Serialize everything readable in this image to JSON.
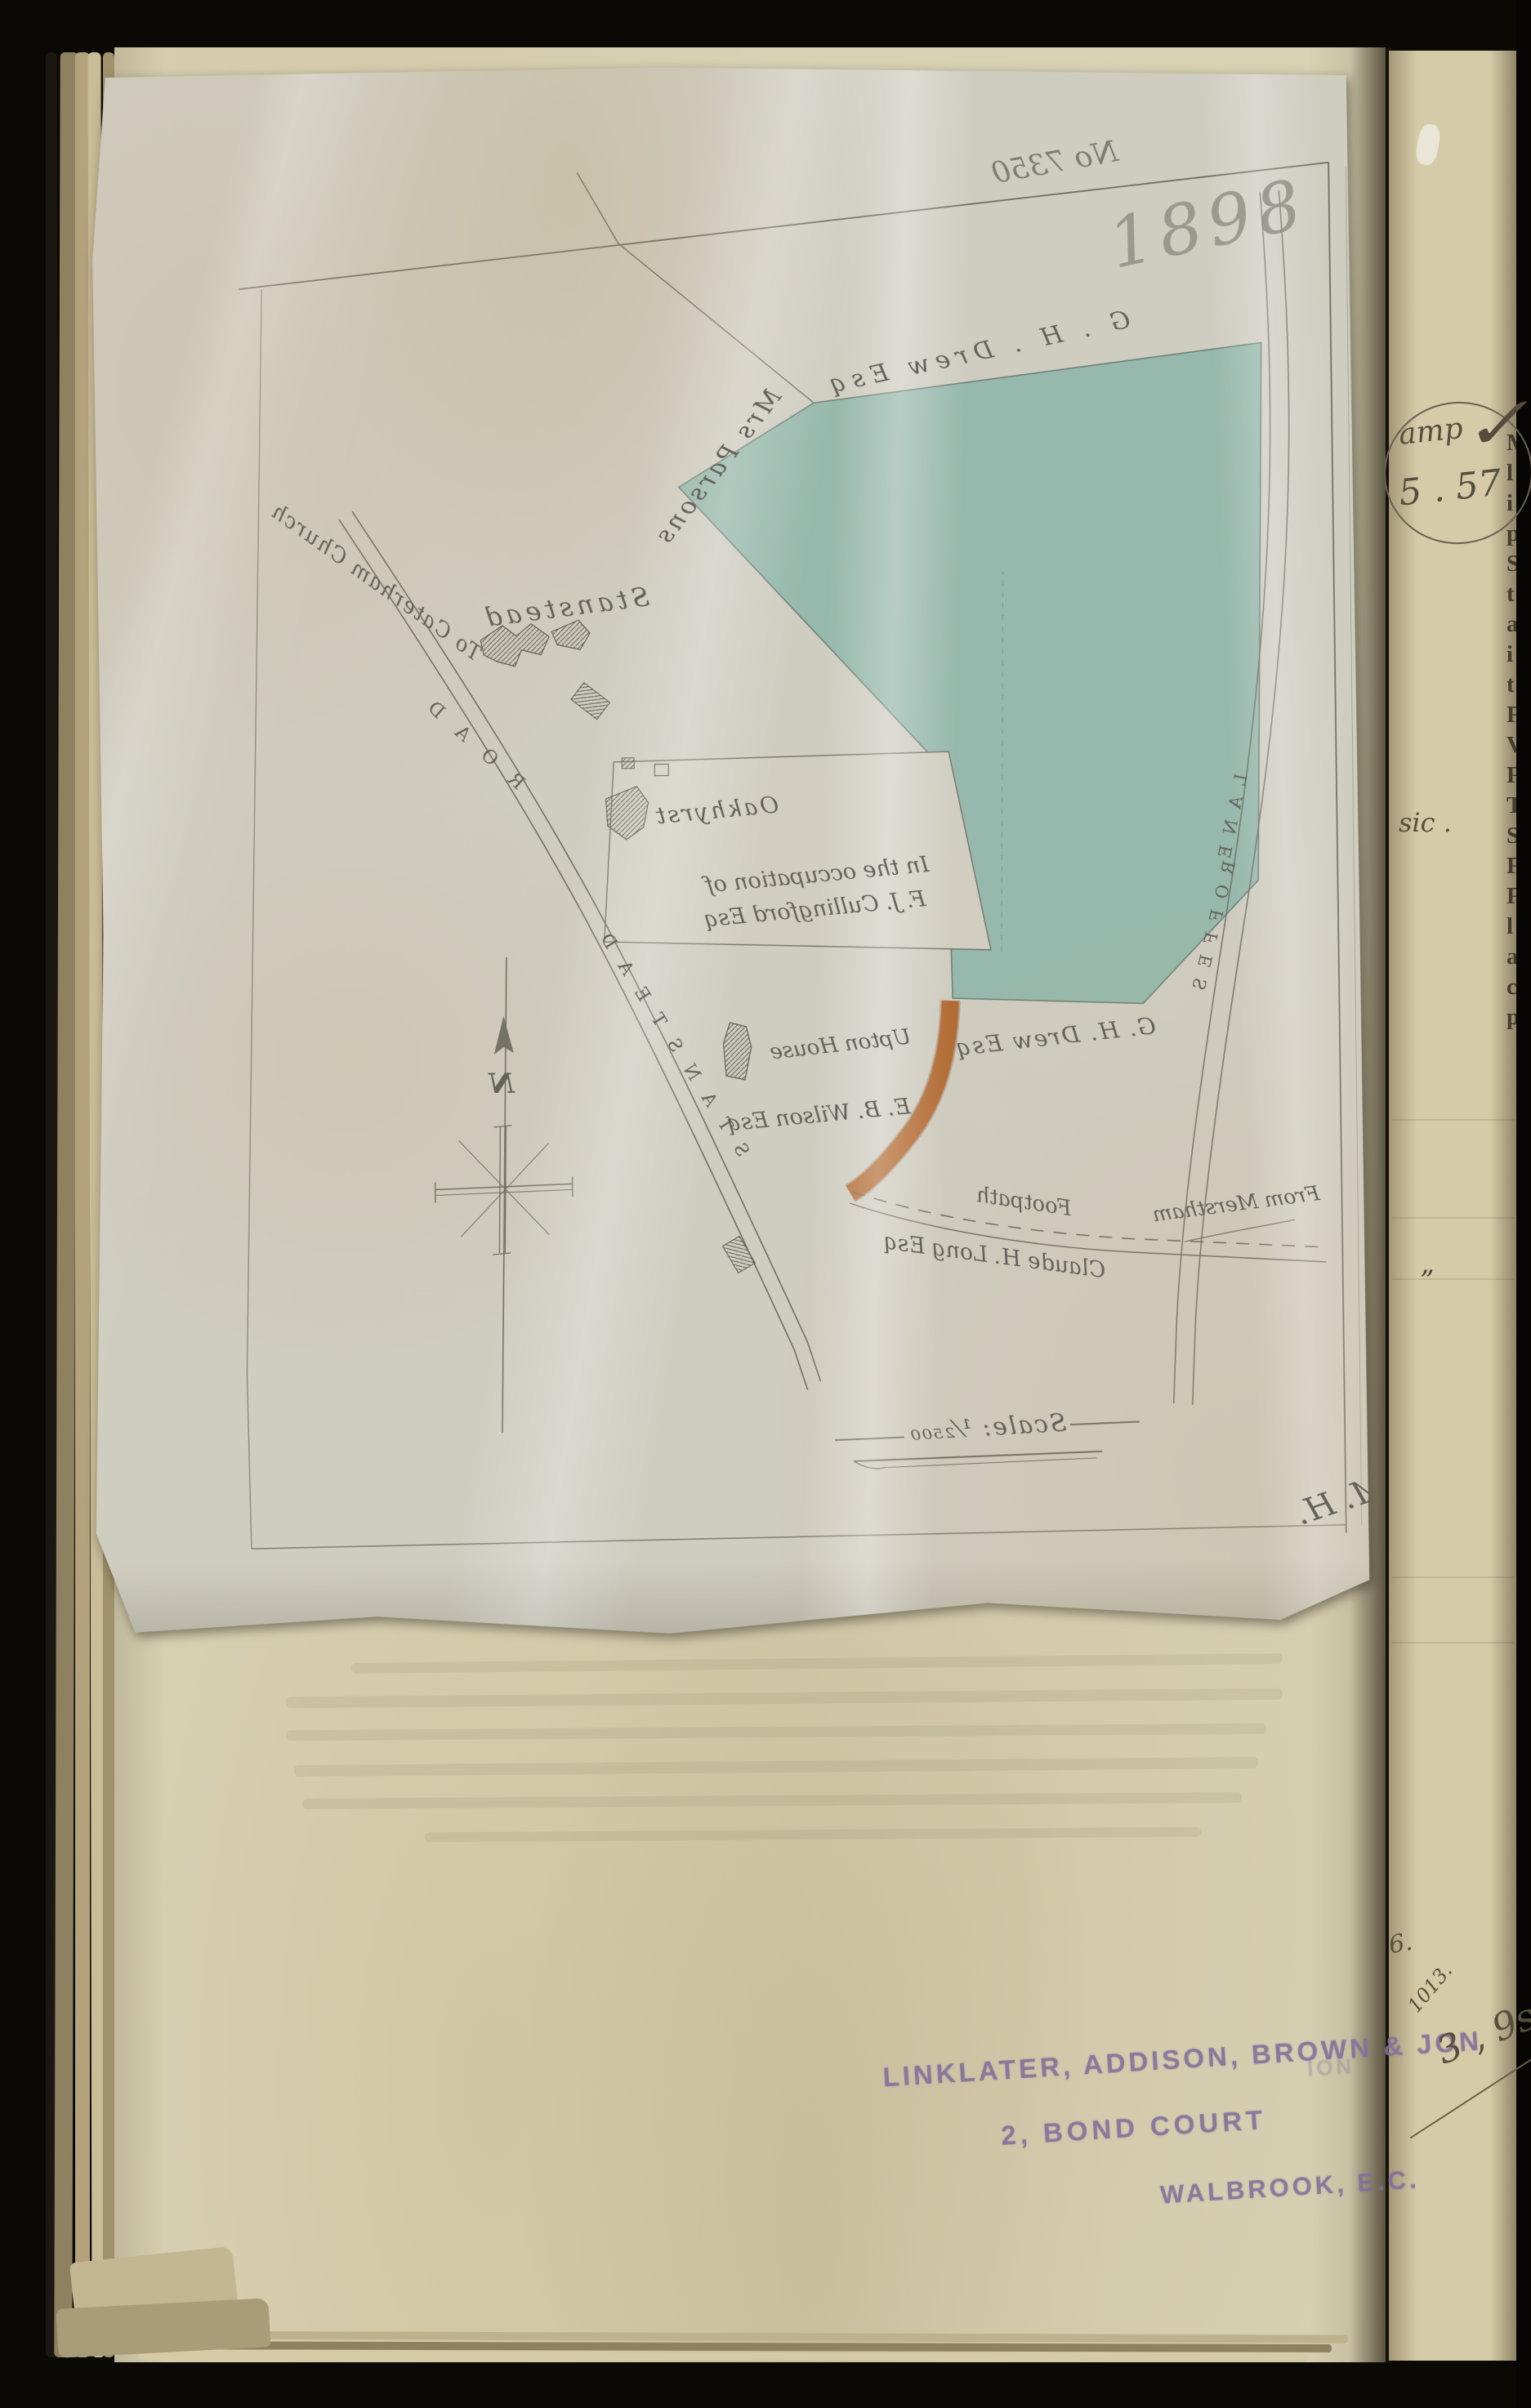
{
  "document": {
    "year_note": "1898",
    "file_note": "No 7350",
    "surveyor_monogram": "M. H."
  },
  "map": {
    "colors": {
      "parcel_green": "#8fb5a9",
      "footpath_orange": "#b2672e",
      "ink": "#63625a",
      "pencil": "#8f8d84"
    },
    "labels": {
      "owner_top": "G . H . Drew Esq",
      "mrs_parsons": "Mrs Parsons",
      "stanstead": "Stanstead",
      "to_caterham_church": "To Caterham Church",
      "road": "ROAD",
      "stanstead_road": "STANSTEAD",
      "oakhyrst": "Oakhyrst",
      "occupation_line1": "In the occupation of",
      "occupation_line2": "F. J. Cullingford Esq",
      "owner_mid": "G. H. Drew Esq",
      "upton_house": "Upton House",
      "wilson": "E. B. Wilson Esq",
      "footpath": "Footpath",
      "claude_long": "Claude H. Long Esq",
      "from_merstham": "From Merstham",
      "roffes": "ROFFES",
      "lane": "LANE",
      "north": "N",
      "scale": "Scale: ¹⁄₂₅₀₀"
    }
  },
  "stamp": {
    "line1": "LINKLATER, ADDISON, BROWN & JON",
    "line2": "2, BOND COURT",
    "line3": "WALBROOK, E.C.",
    "ghost_fragment": "ION",
    "color": "#8b7aa0"
  },
  "right_page": {
    "oval_note_word": "amp",
    "oval_note_number": "5 . 57",
    "sic_note": "sic .",
    "quote_mark": "”",
    "edge_letters": "M\nl\ni\np\nS\nt\na\ni\nt\nF\nV\nF\nT\nS\nF\nF\nl\na\nc\np",
    "ledger_note_a": "6.",
    "ledger_note_b": "1013.",
    "ledger_note_c": "3 , 9s"
  }
}
